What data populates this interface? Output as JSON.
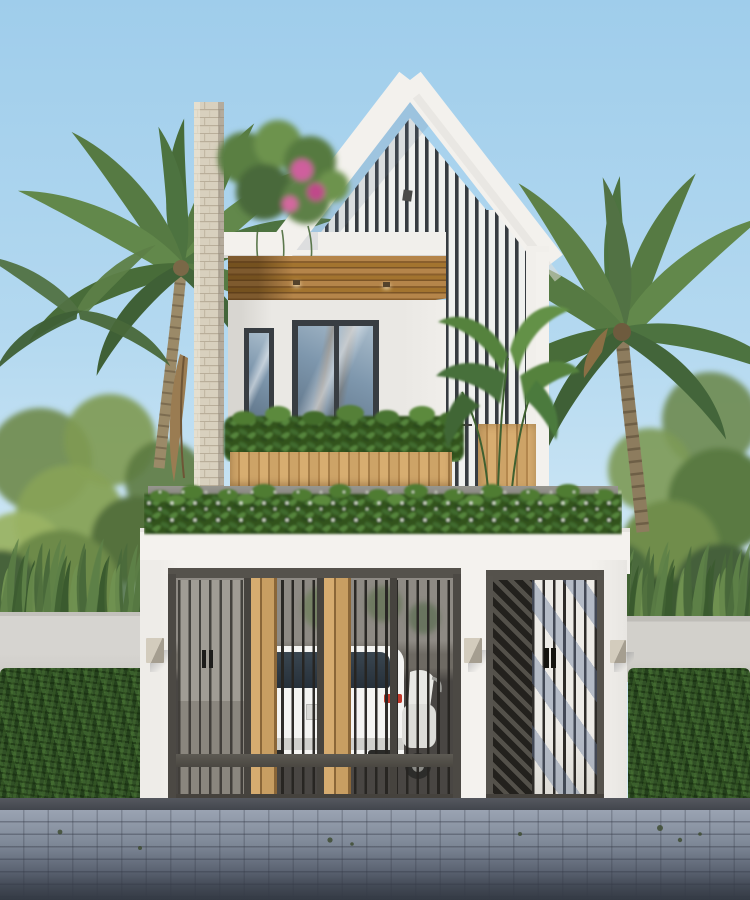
{
  "meta": {
    "type": "architectural-exterior-render",
    "description": "Photorealistic render of a narrow two-storey modern tropical minimalist house, front elevation, daytime",
    "canvas": {
      "width": 750,
      "height": 900
    }
  },
  "palette": {
    "sky_top": "#9fcdeb",
    "sky_low": "#cfe7f5",
    "wall_white": "#f3f1ed",
    "wall_shade": "#e4e2dd",
    "wall_shadow": "#cdcbc7",
    "slat_dark": "#363b40",
    "soffit_wood": "#a3742f",
    "plank_wood": "#cda367",
    "metal": "#4c4944",
    "metal_dark": "#2f2d2a",
    "brick": "#d9d1bf",
    "glass_blue": "#7e97ad",
    "leaf_dark": "#2e4b25",
    "leaf_mid": "#4f7437",
    "leaf_light": "#7fa350",
    "palm_green": "#567a43",
    "trunk_brown": "#9b8a68",
    "hedge_green": "#2c4a24",
    "grey_wall": "#d6d4d0",
    "pavement": "#8d96a6",
    "pavement_dark": "#3b4049",
    "taillight_red": "#c0392b",
    "bougainvillea_pink": "#cf5f9d",
    "lamp_beige": "#d3ccbd",
    "car_white": "#f4f4f2"
  },
  "scene": {
    "background": {
      "sky": "clear light-blue sky",
      "left_palm": "coconut palm leaning over house from left",
      "right_palm": "coconut palm crown right of house",
      "trees": "dense tropical trees flanking both sides",
      "spiky_plants": "pandanus-like striped plants above both boundary walls",
      "boundary_walls": "light grey rendered walls left and right",
      "hedges": "clipped dark-green hedges in front of both boundary walls"
    },
    "house": {
      "gable": "white-framed gable with dark vertical slat infill and small lamp",
      "slat_wing": "vertical slat band continuing down right side of upper floor",
      "brick_column": "tall light brick pier on left with rooftop bougainvillea",
      "soffit": "wood slat ceiling over recessed balcony with two downlights",
      "windows": "narrow fixed window and wide sliding glass door, dark frames",
      "balcony": "thin black railing, slatted wood planter full of plants",
      "wood_screen": "vertical wood slat screen with banana plant at right",
      "roof_edge": "grey slab band with continuous flowering plant bed",
      "fascia": "plain white fascia band above ground floor"
    },
    "ground_floor": {
      "main_gate": "four-panel dark metal gate, thin vertical bars, two pairs of wood plank accents, mid rail",
      "behind_gate": "white car rear with red taillights and a scooter in carport",
      "side_gate": "pedestrian gate, diagonal slat left half, barred right half with sun shadows",
      "wall_lamps": "three small beige cube wall lamps"
    },
    "foreground": {
      "driveway_shadow": "dark strip under gates",
      "sidewalk": "grey-blue paver sidewalk darkening to street edge at bottom"
    }
  }
}
